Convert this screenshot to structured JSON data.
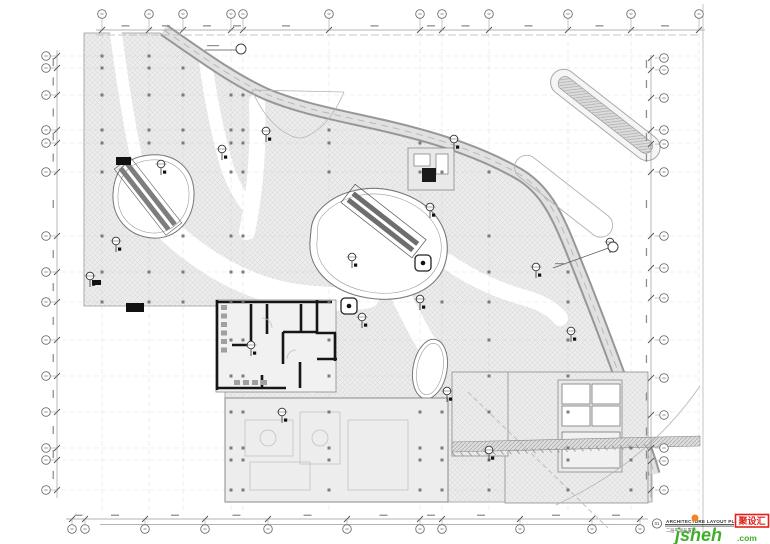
{
  "sheet": {
    "number": "01",
    "title": "ARCHITECTURE  LAYOUT  PLAN",
    "subtitle": "二层平面布置图"
  },
  "brand": {
    "name": "jsheh",
    "suffix": ".com",
    "badge": "聚设汇"
  },
  "colors": {
    "paper": "#ffffff",
    "hatch_fill": "#ececec",
    "hatch_line": "#d7d7d7",
    "line": "#8f8f8f",
    "grid_line": "#c8c8c8",
    "wall": "#161616",
    "road_edge": "#979797",
    "road_fill": "#e1e1e1",
    "bubble_stroke": "#6e6e6e",
    "logo_green": "#3fae2a",
    "logo_orange": "#f58220",
    "logo_red": "#e2211c"
  },
  "grid": {
    "top_x": [
      102,
      149,
      183,
      231,
      243,
      329,
      420,
      442,
      489,
      568,
      631,
      699
    ],
    "bottom_x": [
      72,
      85,
      145,
      205,
      268,
      347,
      420,
      442,
      520,
      592,
      640
    ],
    "left_y": [
      56,
      68,
      95,
      130,
      143,
      172,
      236,
      272,
      302,
      340,
      376,
      412,
      448,
      460,
      490
    ],
    "right_y": [
      58,
      70,
      98,
      130,
      144,
      172,
      236,
      268,
      298,
      340,
      378,
      415,
      448,
      461,
      490
    ]
  },
  "symbols": {
    "survey_markers": [
      [
        266,
        131
      ],
      [
        222,
        149
      ],
      [
        161,
        164
      ],
      [
        116,
        241
      ],
      [
        90,
        276
      ],
      [
        352,
        257
      ],
      [
        362,
        317
      ],
      [
        420,
        299
      ],
      [
        447,
        391
      ],
      [
        489,
        450
      ],
      [
        610,
        242
      ],
      [
        536,
        267
      ],
      [
        454,
        139
      ],
      [
        282,
        412
      ],
      [
        251,
        345
      ],
      [
        430,
        207
      ],
      [
        571,
        331
      ]
    ],
    "kiosks": [
      [
        423,
        263
      ],
      [
        349,
        306
      ]
    ],
    "callouts": [
      [
        241,
        49,
        -36,
        1
      ],
      [
        613,
        247,
        -60,
        21
      ]
    ],
    "black_boxes": [
      [
        116,
        157,
        15,
        8
      ],
      [
        126,
        303,
        18,
        9
      ],
      [
        92,
        280,
        9,
        5
      ]
    ]
  }
}
